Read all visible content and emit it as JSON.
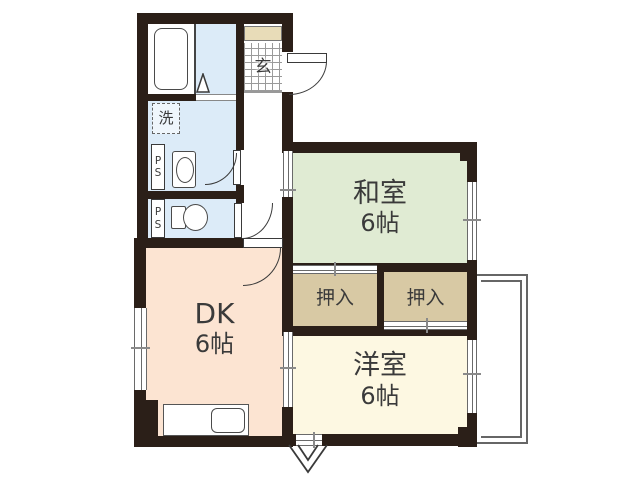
{
  "rooms": {
    "washitsu": {
      "name": "和室",
      "size": "6帖"
    },
    "dk": {
      "name": "DK",
      "size": "6帖"
    },
    "youshitsu": {
      "name": "洋室",
      "size": "6帖"
    },
    "closet_left": {
      "name": "押入"
    },
    "closet_right": {
      "name": "押入"
    }
  },
  "labels": {
    "genkan": "玄",
    "laundry": "洗",
    "pipe_space": "PS",
    "pipe_space2": "PS"
  },
  "colors": {
    "wall": "#2b1f18",
    "tatami": "#e0ebd3",
    "dk": "#fce4d2",
    "western": "#fdf8e2",
    "closet": "#d8c9a4",
    "bath": "#dcebf8",
    "cabinet": "#e8dcb8"
  }
}
